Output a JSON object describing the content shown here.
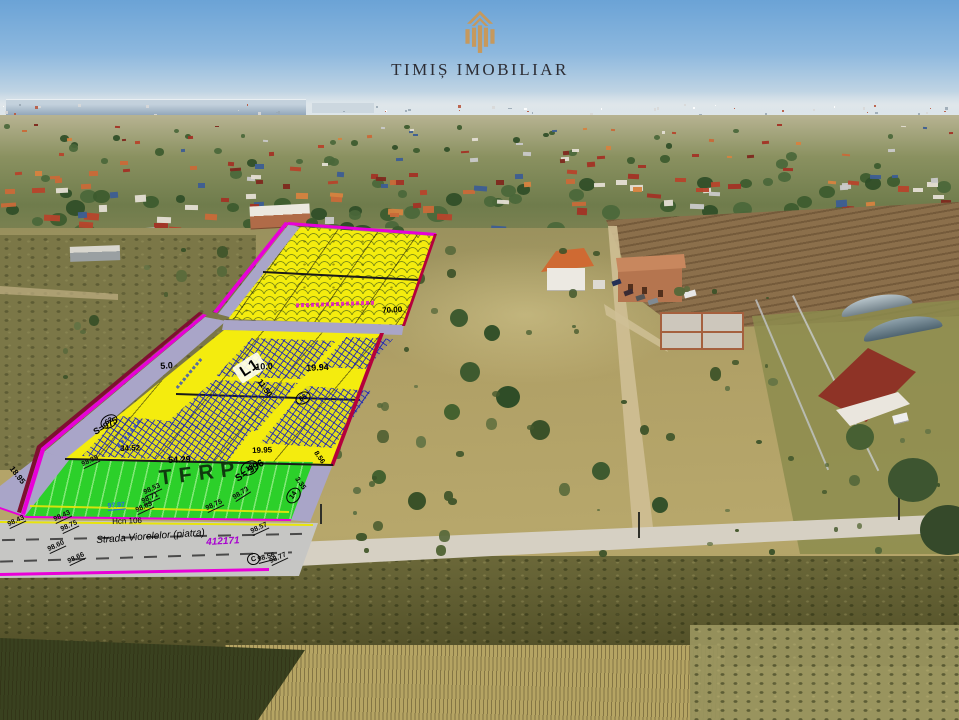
{
  "branding": {
    "logo_text": "TIMIȘ IMOBILIAR",
    "logo_icon": "building-columns-icon",
    "logo_color": "#c6995d",
    "text_color": "#2d2d34"
  },
  "plan": {
    "zone_label": "L1",
    "tfrp_label": "TFRP",
    "road": {
      "street": "Strada Viorelelor (piatra)",
      "cad": "412171",
      "hcn": "Hcn 106"
    },
    "parcels": {
      "p18": {
        "no": "18",
        "area": "S= 996"
      },
      "p62": {
        "no": "62",
        "area": "S=975"
      },
      "p65": {
        "no": "65"
      },
      "p14": {
        "no": "14"
      },
      "c_point": "C"
    },
    "dims": {
      "d5": "5.0",
      "d10": "10.0",
      "d19_94": "19.94",
      "d54_29": "54.29",
      "d34_52": "34.52",
      "d19_95": "19.95",
      "d70": "70.00",
      "d11_50": "11.50",
      "d18_95": "18.95",
      "d8_56": "8.56",
      "d3_35": "3.35"
    },
    "elevations": [
      "98.43",
      "98.75",
      "98.60",
      "98.66",
      "98.57",
      "98.77",
      "98.38",
      "98.53",
      "98.71",
      "98.83",
      "98.73",
      "97.97",
      "98.56"
    ],
    "colors": {
      "parcel_yellow": "#f4ec0e",
      "green": "#2cd02a",
      "road_strip": "#a9a5c8",
      "magenta": "#e800d8",
      "boundary_red": "#b4003c",
      "hatch_blue": "#1923b9",
      "road_gray": "#c6c6c4"
    }
  },
  "scenery": {
    "sky_top": "#6ba3d6",
    "sky_horizon": "#dfe7ea",
    "village": {
      "houses": 165,
      "trees": 95,
      "roof_colors": [
        "#b6452c",
        "#c96a38",
        "#a23325",
        "#d5823f",
        "#3d5e93",
        "#e3ded2",
        "#7e2a1e",
        "#c9c9c9"
      ],
      "tree_colors": [
        "#3c5a2e",
        "#2f4d27",
        "#4a673a"
      ]
    },
    "far_specks": 70,
    "speck_colors": [
      "#ffffff",
      "#d8d8d8",
      "#b85840",
      "#9aa8b5"
    ],
    "field_bushes": {
      "count": 85,
      "colors": [
        "#44582c",
        "#3a5128",
        "#56683a",
        "#627244"
      ]
    }
  }
}
